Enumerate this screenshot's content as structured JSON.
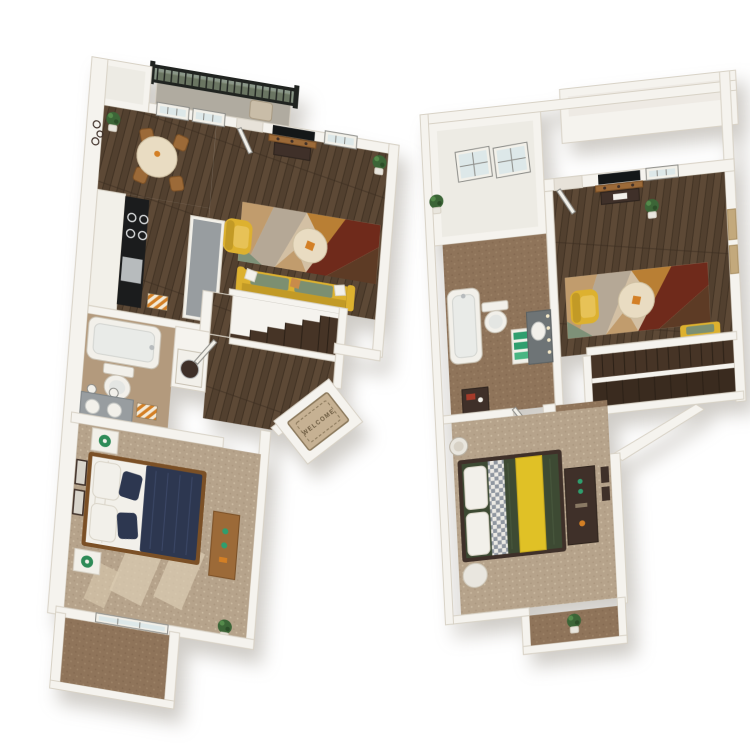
{
  "scene": {
    "background": "#ffffff",
    "welcome_mat": {
      "text": "WELCOME"
    },
    "colors": {
      "wall": "#f5f3ee",
      "wall-shade": "#e7e2d9",
      "wall-edge": "#d8d2c6",
      "interior-light": "#edebe4",
      "floor-wood": "#52402f",
      "wood-plank-light": "#6a553f",
      "wood-seam": "#382a1e",
      "carpet-tan": "#b6a38b",
      "carpet-tan-dark": "#9f8c74",
      "carpet-tan-light": "#dacbb1",
      "carpet-brown": "#8f745a",
      "carpet-brown-dark": "#7a6048",
      "carpet-brown-light": "#a78d6f",
      "bath-floor": "#b39a7d",
      "balcony-gray": "#b0aba0",
      "railing-black": "#202320",
      "railing-green": "#31492f",
      "patio-brown": "#94785d",
      "rug-cream": "#d3c0a4",
      "rug-tan": "#c19c6d",
      "rug-caramel": "#b97f34",
      "rug-maroon": "#6f2a1b",
      "rug-brown": "#5d3b25",
      "rug-green": "#7e9178",
      "rug-gray": "#b5a896",
      "chair-yellow": "#ddb12f",
      "chair-yellow-dark": "#c29a26",
      "cushion-green": "#7c8f71",
      "table-cream": "#e9dcc2",
      "bed-navy": "#2d3750",
      "navy-light": "#3c4867",
      "linen-white": "#f2f0ea",
      "linen-shade": "#d9d4c8",
      "bed-green": "#3d4a33",
      "duvet-fold": "#47563c",
      "runner-yellow": "#e0c126",
      "runner-edge": "#c7aa1e",
      "check-base": "#eceae4",
      "check-gray": "#9097a0",
      "stair-wood": "#463426",
      "stair-dark": "#3a2b1f",
      "stair-seam": "#2c2117",
      "counter-black": "#1b1c1d",
      "counter-gray": "#989da0",
      "vanity-dark": "#6e7476",
      "steel": "#b7bbbd",
      "cabinet-white": "#f2f0e9",
      "wood-furn": "#9c6a38",
      "wood-furn-dark": "#7b5026",
      "dark-furn": "#3f3029",
      "lamp-green": "#2e8b57",
      "towel-green": "#2f9e6e",
      "accent-orange": "#d37f25",
      "red-accent": "#a63b2a",
      "mat-tan": "#c6b193",
      "mat-border": "#8b795c",
      "mat-text": "#6b5a40",
      "stripe-cream": "#f3ead8",
      "glass": "#dde8e9",
      "frame-gray": "#8d8d89",
      "art-tan": "#c3a97c",
      "plant-green": "#3c6537",
      "pot-white": "#e9e6de",
      "tv-black": "#141718",
      "bulb-warm": "#f5e9c8"
    },
    "plans": [
      {
        "id": "left-unit",
        "rooms": [
          "balcony",
          "dining",
          "kitchen",
          "living",
          "bathroom",
          "laundry",
          "bedroom",
          "entry",
          "stairs",
          "patio"
        ]
      },
      {
        "id": "right-unit",
        "rooms": [
          "living",
          "bathroom",
          "hall",
          "stairs",
          "bedroom",
          "entry-nook"
        ]
      }
    ]
  }
}
